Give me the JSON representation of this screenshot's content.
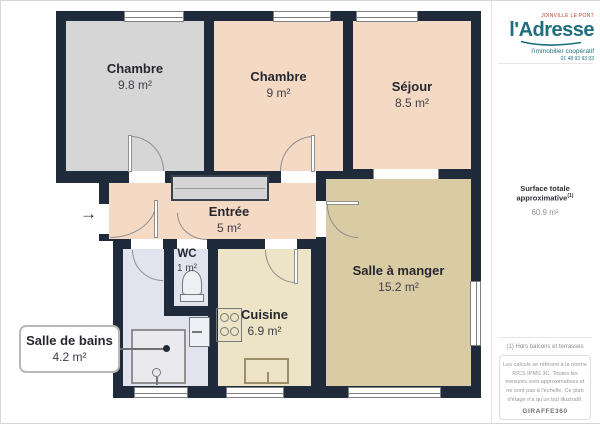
{
  "plan": {
    "entrance_arrow": "→",
    "rooms": [
      {
        "name": "Chambre",
        "area": "9.8 m²"
      },
      {
        "name": "Chambre",
        "area": "9 m²"
      },
      {
        "name": "Séjour",
        "area": "8.5 m²"
      },
      {
        "name": "Entrée",
        "area": "5 m²"
      },
      {
        "name": "WC",
        "area": "1 m²"
      },
      {
        "name": "Cuisine",
        "area": "6.9 m²"
      },
      {
        "name": "Salle à manger",
        "area": "15.2 m²"
      },
      {
        "name": "Salle de bains",
        "area": "4.2 m²"
      }
    ],
    "colors": {
      "wall": "#1f2b3b",
      "bedroom_gray": "#d6d6d6",
      "living_peach": "#f4d9c5",
      "dining_khaki": "#d9cca4",
      "kitchen_cream": "#ede4c8",
      "bath_lavender": "#e1e4ee"
    }
  },
  "sidebar": {
    "logo": {
      "location": "JOINVILLE LE PONT",
      "brand": "l'Adresse",
      "tagline": "l'immobilier coopératif",
      "phone": "01 48 93 93 93",
      "brand_color": "#1d6f7e"
    },
    "surface": {
      "label": "Surface totale approximative",
      "note_ref": "(1)",
      "value": "60.9 m²"
    },
    "footnote": "(1) Hors balcons et terrasses",
    "disclaimer": "Les calculs se réfèrent à la norme RICS IPMS 3C. Toutes les mesures sont approximatives et ne sont pas à l'échelle. Ce plan d'étage n'a qu'un but illustratif.",
    "provider": "GIRAFFE360"
  }
}
